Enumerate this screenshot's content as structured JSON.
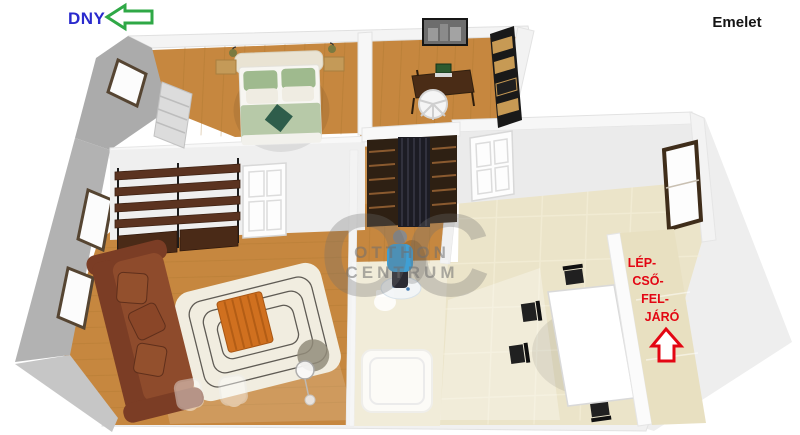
{
  "compass": {
    "label": "DNY",
    "label_color": "#2a2acd",
    "arrow_color": "#2fa846",
    "direction": "left"
  },
  "floor_title": {
    "text": "Emelet",
    "color": "#151515"
  },
  "staircase_label": {
    "lines": [
      "LÉP-",
      "CSŐ-",
      "FEL-",
      "JÁRÓ"
    ],
    "color": "#e30613",
    "arrow_direction": "up"
  },
  "watermark": {
    "monogram": "OC",
    "name_line1": "OTTHON",
    "name_line2": "CENTRUM",
    "color": "#6f6f6f"
  },
  "palette": {
    "wood_floor": "#c6873f",
    "tile_floor": "#ebe4c9",
    "stair_floor": "#e8e0c1",
    "wall_shadow": "#b2b2b2",
    "sofa": "#8e4b2c",
    "coffee_table": "#d0701f",
    "dining_chair": "#202020",
    "person_shirt": "#3f9fd4"
  }
}
